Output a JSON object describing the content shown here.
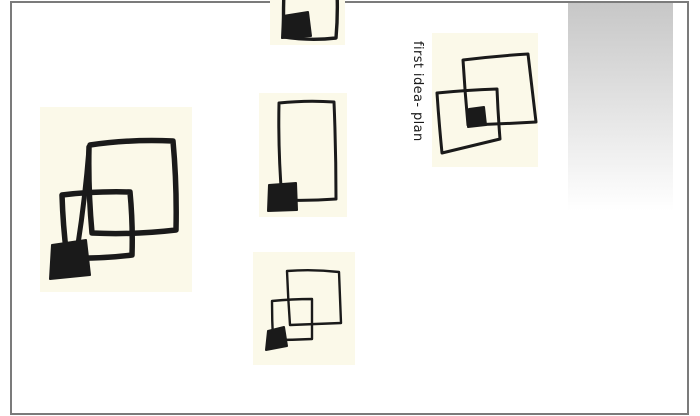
{
  "page": {
    "caption": "first idea- plan",
    "colors": {
      "background": "#ffffff",
      "frame": "#7b7b7b",
      "note_background": "#fbf9e9",
      "ink": "#1a1a1a",
      "gradient_top": "#c7c7c7",
      "gradient_bottom": "#ffffff"
    },
    "notes": [
      {
        "name": "sketch-note-top",
        "alt": "square outline with filled corner block, cropped by page top"
      },
      {
        "name": "sketch-note-left",
        "alt": "two overlapping squares with filled corner block"
      },
      {
        "name": "sketch-note-middle",
        "alt": "tall rectangle with filled corner block"
      },
      {
        "name": "sketch-note-right",
        "alt": "two overlapping tilted squares with filled centre block"
      },
      {
        "name": "sketch-note-bottom",
        "alt": "two overlapping squares with filled corner block"
      }
    ]
  }
}
